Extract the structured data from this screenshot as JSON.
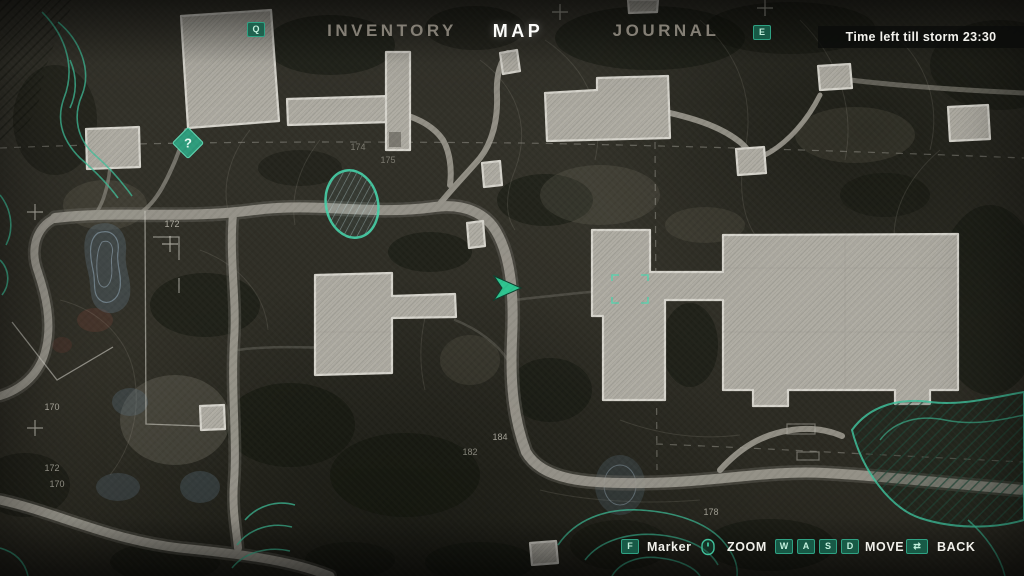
{
  "accent_color": "#3fbf9a",
  "header": {
    "prev_tab_key": "Q",
    "next_tab_key": "E",
    "tabs": [
      {
        "label": "INVENTORY",
        "active": false
      },
      {
        "label": "MAP",
        "active": true
      },
      {
        "label": "JOURNAL",
        "active": false
      }
    ],
    "storm_timer": "Time left till storm 23:30"
  },
  "hud_hints": {
    "marker": {
      "key": "F",
      "label": "Marker"
    },
    "zoom": {
      "key_icon": "mouse-wheel-icon",
      "label": "ZOOM"
    },
    "move": {
      "keys": [
        "W",
        "A",
        "S",
        "D"
      ],
      "label": "MOVE"
    },
    "back": {
      "key_glyph": "⇄",
      "label": "BACK"
    }
  },
  "map": {
    "question_marker": "?",
    "elevation_labels": [
      {
        "text": "172"
      },
      {
        "text": "174"
      },
      {
        "text": "175"
      },
      {
        "text": "170"
      },
      {
        "text": "172"
      },
      {
        "text": "170"
      },
      {
        "text": "184"
      },
      {
        "text": "182"
      },
      {
        "text": "178"
      }
    ]
  }
}
